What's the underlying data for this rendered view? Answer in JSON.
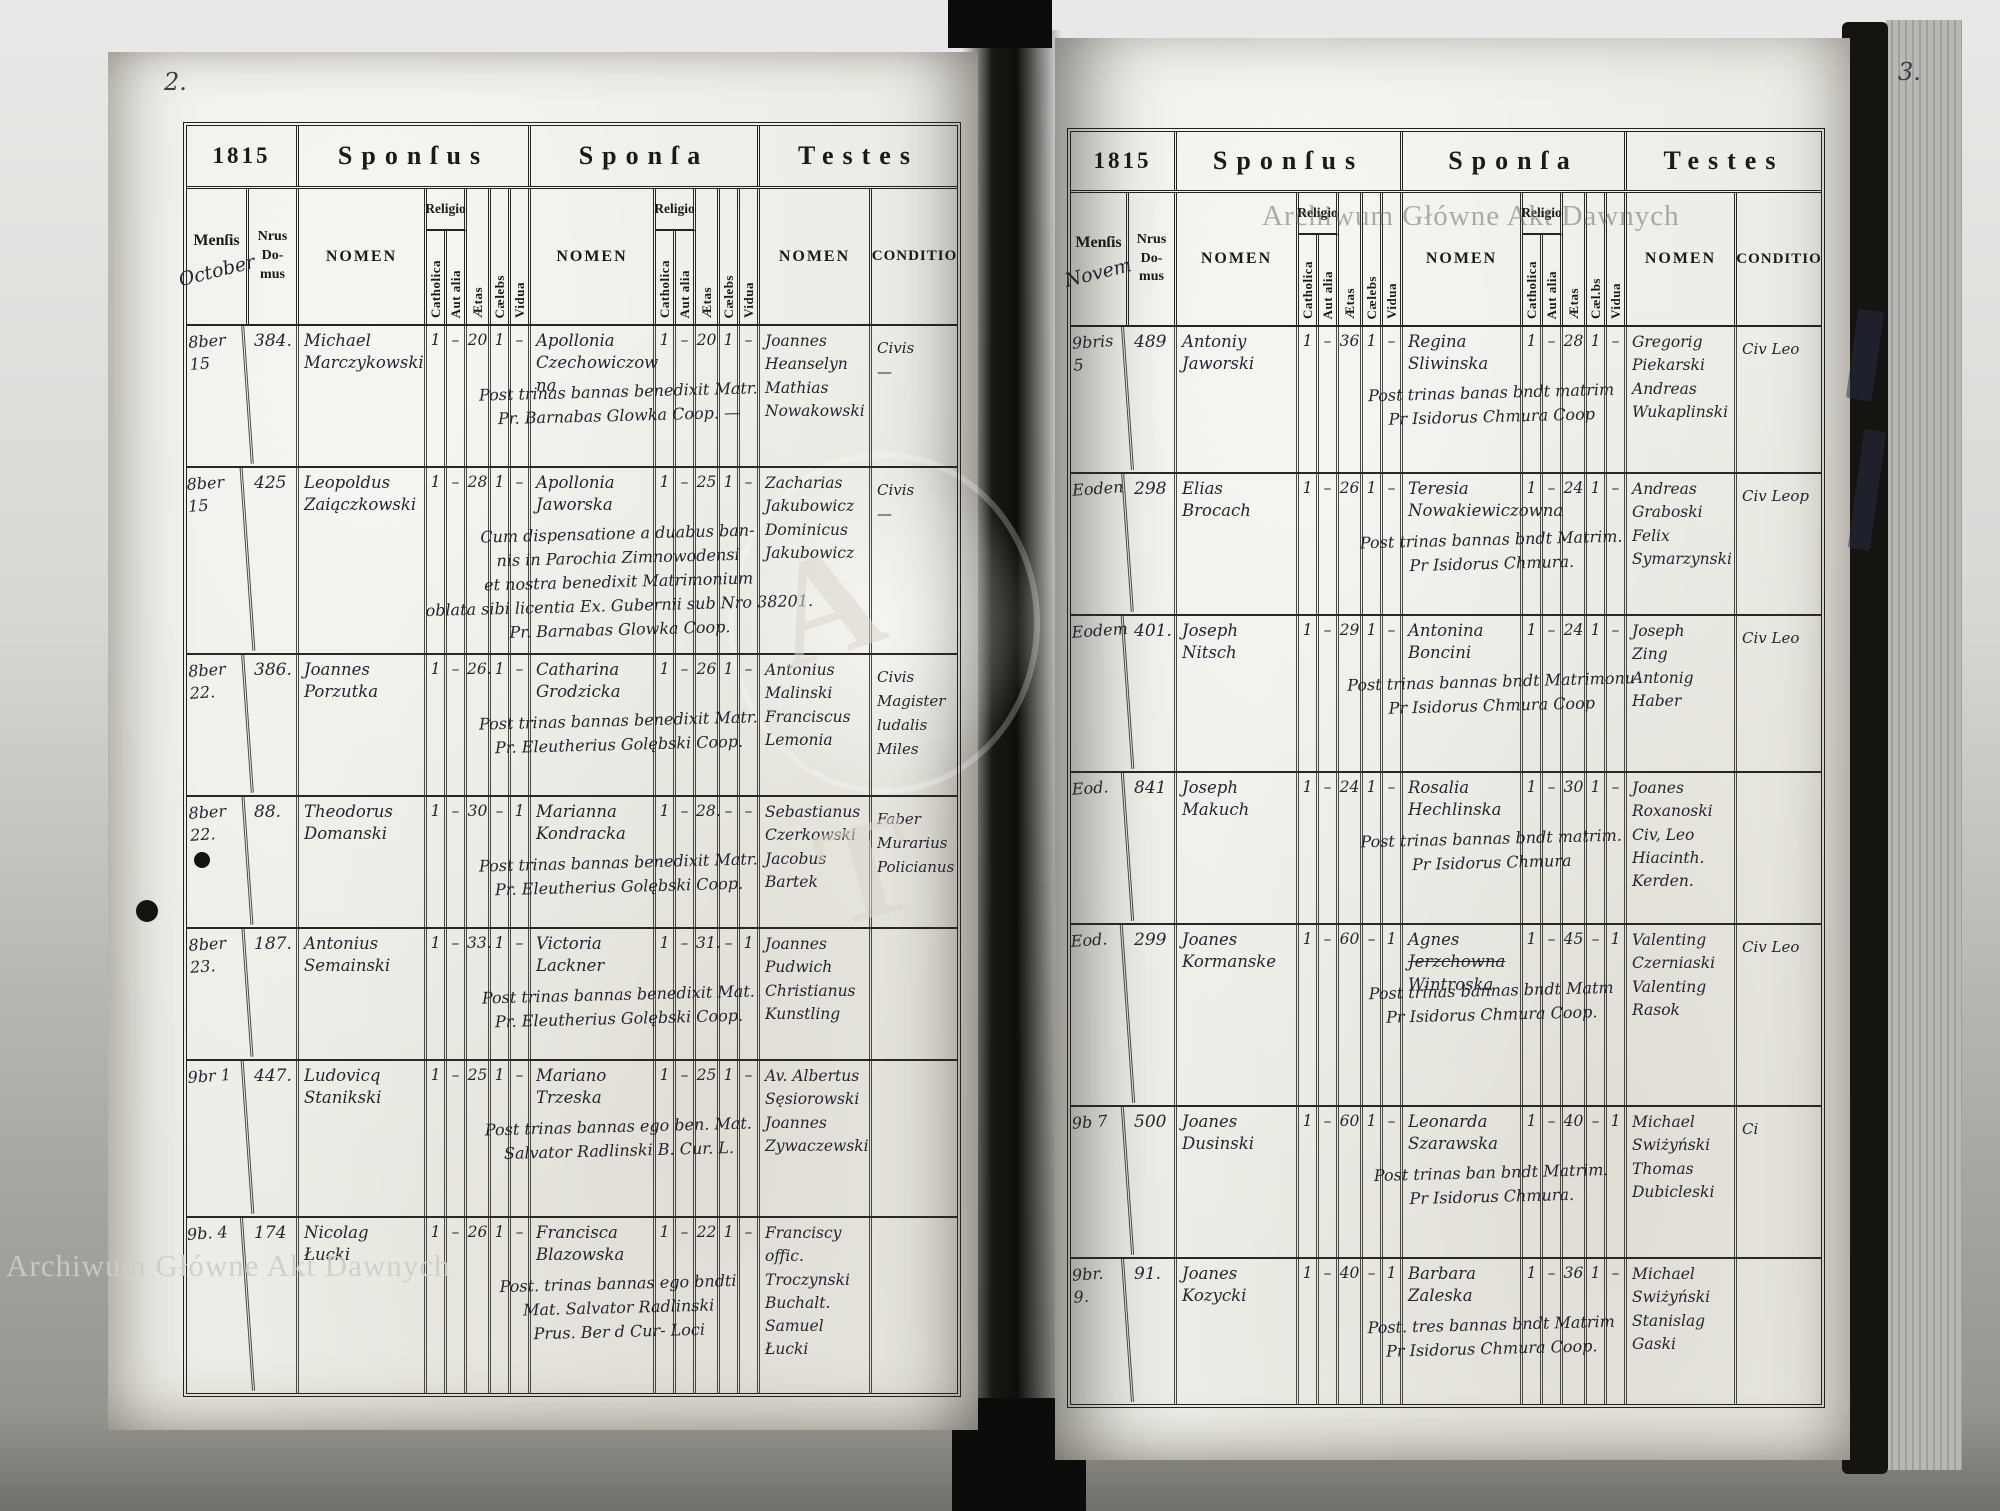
{
  "scan": {
    "watermark_top_right": "Archiwum Główne Akt Dawnych",
    "watermark_bottom_left": "Archiwum Główne Akt Dawnych",
    "ghost_letter_a": "A",
    "ghost_letter_t": "T"
  },
  "headers": {
    "year": "1815",
    "sponsus": "Sponſus",
    "sponsa": "Sponſa",
    "testes": "Testes",
    "mensis": "Menſis",
    "nrus_domus": "Nrus\nDo-\nmus",
    "nomen": "NOMEN",
    "religio": "Religio",
    "catholica": "Catholica",
    "aut_alia": "Aut alia",
    "aetas": "Ætas",
    "caelebs": "Cælebs",
    "caelebs_alt": "Cæl.bs",
    "vidua": "Vidua",
    "conditio": "CONDITIO"
  },
  "left_page": {
    "page_number": "2.",
    "month_script": "October",
    "rows": [
      {
        "date": "8ber 15",
        "no": "384.",
        "g_name": "Michael\nMarczykowski",
        "g_cath": "1",
        "g_alia": "–",
        "g_aetas": "20",
        "g_cael": "1",
        "g_vid": "–",
        "b_name": "Apollonia\nCzechowiczow\nna",
        "b_struck": "",
        "b_name3": "",
        "b_cath": "1",
        "b_alia": "–",
        "b_aetas": "20",
        "b_cael": "1",
        "b_vid": "–",
        "note": "Post trinas bannas benedixit Matr.\nPr. Barnabas Glowka Coop. —",
        "testes": "Joannes\nHeanselyn\nMathias\nNowakowski",
        "cond": "Civis\n—"
      },
      {
        "date": "8ber 15",
        "no": "425",
        "g_name": "Leopoldus\nZaiączkowski",
        "g_cath": "1",
        "g_alia": "–",
        "g_aetas": "28",
        "g_cael": "1",
        "g_vid": "–",
        "b_name": "Apollonia\nJaworska",
        "b_struck": "",
        "b_name3": "",
        "b_cath": "1",
        "b_alia": "–",
        "b_aetas": "25",
        "b_cael": "1",
        "b_vid": "–",
        "note": "Cum dispensatione a duabus ban-\nnis in Parochia Zimnowodensi\net nostra benedixit Matrimonium\noblata sibi licentia Ex. Gubernii sub Nro 38201.\nPr. Barnabas Glowka Coop.",
        "testes": "Zacharias\nJakubowicz\nDominicus\nJakubowicz",
        "cond": "Civis\n—"
      },
      {
        "date": "8ber 22.",
        "no": "386.",
        "g_name": "Joannes\nPorzutka",
        "g_cath": "1",
        "g_alia": "–",
        "g_aetas": "26.",
        "g_cael": "1",
        "g_vid": "–",
        "b_name": "Catharina\nGrodzicka",
        "b_struck": "",
        "b_name3": "",
        "b_cath": "1",
        "b_alia": "–",
        "b_aetas": "26",
        "b_cael": "1",
        "b_vid": "–",
        "note": "Post trinas bannas benedixit Matr.\nPr. Eleutherius Golębski Coop.",
        "testes": "Antonius\nMalinski\nFranciscus\nLemonia",
        "cond": "Civis\nMagister\nludalis Miles"
      },
      {
        "date": "8ber 22.",
        "no": "88.",
        "g_name": "Theodorus\nDomanski",
        "g_cath": "1",
        "g_alia": "–",
        "g_aetas": "30",
        "g_cael": "–",
        "g_vid": "1",
        "b_name": "Marianna\nKondracka",
        "b_struck": "",
        "b_name3": "",
        "b_cath": "1",
        "b_alia": "–",
        "b_aetas": "28.",
        "b_cael": "–",
        "b_vid": "–",
        "note": "Post trinas bannas benedixit Matr.\nPr. Eleutherius Golębski Coop.",
        "testes": "Sebastianus\nCzerkowski\nJacobus\nBartek",
        "cond": "Faber\nMurarius\nPolicianus"
      },
      {
        "date": "8ber 23.",
        "no": "187.",
        "g_name": "Antonius\nSemainski",
        "g_cath": "1",
        "g_alia": "–",
        "g_aetas": "33.",
        "g_cael": "1",
        "g_vid": "–",
        "b_name": "Victoria\nLackner",
        "b_struck": "",
        "b_name3": "",
        "b_cath": "1",
        "b_alia": "–",
        "b_aetas": "31.",
        "b_cael": "–",
        "b_vid": "1",
        "note": "Post trinas bannas benedixit Mat.\nPr. Eleutherius Golębski Coop.",
        "testes": "Joannes\nPudwich\nChristianus\nKunstling",
        "cond": ""
      },
      {
        "date": "9br 1",
        "no": "447.",
        "g_name": "Ludovicq\nStanikski",
        "g_cath": "1",
        "g_alia": "–",
        "g_aetas": "25",
        "g_cael": "1",
        "g_vid": "–",
        "b_name": "Mariano\nTrzeska",
        "b_struck": "",
        "b_name3": "",
        "b_cath": "1",
        "b_alia": "–",
        "b_aetas": "25",
        "b_cael": "1",
        "b_vid": "–",
        "note": "Post trinas bannas ego ben. Mat.\nSalvator Radlinski B. Cur. L.",
        "testes": "Av. Albertus\nSęsiorowski\nJoannes\nZywaczewski",
        "cond": ""
      },
      {
        "date": "9b. 4",
        "no": "174",
        "g_name": "Nicolag\nŁucki",
        "g_cath": "1",
        "g_alia": "–",
        "g_aetas": "26",
        "g_cael": "1",
        "g_vid": "–",
        "b_name": "Francisca\nBlazowska",
        "b_struck": "",
        "b_name3": "",
        "b_cath": "1",
        "b_alia": "–",
        "b_aetas": "22",
        "b_cael": "1",
        "b_vid": "–",
        "note": "Post. trinas bannas ego bndti\nMat. Salvator Radlinski\nPrus. Ber d Cur- Loci",
        "testes": "Franciscy offic.\nTroczynski Buchalt.\nSamuel\nŁucki",
        "cond": ""
      }
    ]
  },
  "right_page": {
    "page_number": "3.",
    "month_script": "Novem",
    "rows": [
      {
        "date": "9bris 5",
        "no": "489",
        "g_name": "Antoniy\nJaworski",
        "g_cath": "1",
        "g_alia": "–",
        "g_aetas": "36",
        "g_cael": "1",
        "g_vid": "–",
        "b_name": "Regina\nSliwinska",
        "b_struck": "",
        "b_name3": "",
        "b_cath": "1",
        "b_alia": "–",
        "b_aetas": "28",
        "b_cael": "1",
        "b_vid": "–",
        "note": "Post trinas banas bndt matrim\nPr Isidorus Chmura Coop",
        "testes": "Gregorig\nPiekarski\nAndreas\nWukaplinski",
        "cond": "Civ Leo"
      },
      {
        "date": "Eoden",
        "no": "298",
        "g_name": "Elias\nBrocach",
        "g_cath": "1",
        "g_alia": "–",
        "g_aetas": "26",
        "g_cael": "1",
        "g_vid": "–",
        "b_name": "Teresia\nNowakiewiczowna",
        "b_struck": "",
        "b_name3": "",
        "b_cath": "1",
        "b_alia": "–",
        "b_aetas": "24",
        "b_cael": "1",
        "b_vid": "–",
        "note": "Post trinas bannas bndt Matrim.\nPr Isidorus Chmura.",
        "testes": "Andreas\nGraboski\nFelix\nSymarzynski",
        "cond": "Civ Leop"
      },
      {
        "date": "Eodem",
        "no": "401.",
        "g_name": "Joseph\nNitsch",
        "g_cath": "1",
        "g_alia": "–",
        "g_aetas": "29",
        "g_cael": "1",
        "g_vid": "–",
        "b_name": "Antonina\nBoncini",
        "b_struck": "",
        "b_name3": "",
        "b_cath": "1",
        "b_alia": "–",
        "b_aetas": "24",
        "b_cael": "1",
        "b_vid": "–",
        "note": "Post trinas bannas bndt Matrimonu\nPr Isidorus Chmura Coop",
        "testes": "Joseph\nZing\nAntonig\nHaber",
        "cond": "Civ Leo"
      },
      {
        "date": "Eod.",
        "no": "841",
        "g_name": "Joseph\nMakuch",
        "g_cath": "1",
        "g_alia": "–",
        "g_aetas": "24",
        "g_cael": "1",
        "g_vid": "–",
        "b_name": "Rosalia\nHechlinska",
        "b_struck": "",
        "b_name3": "",
        "b_cath": "1",
        "b_alia": "–",
        "b_aetas": "30",
        "b_cael": "1",
        "b_vid": "–",
        "note": "Post trinas bannas bndt matrim.\nPr Isidorus Chmura",
        "testes": "Joanes\nRoxanoski Civ, Leo\nHiacinth.\nKerden.",
        "cond": ""
      },
      {
        "date": "Eod.",
        "no": "299",
        "g_name": "Joanes\nKormanske",
        "g_cath": "1",
        "g_alia": "–",
        "g_aetas": "60",
        "g_cael": "–",
        "g_vid": "1",
        "b_name": "Agnes",
        "b_struck": "Jerzchowna",
        "b_name3": "Wintroska",
        "b_cath": "1",
        "b_alia": "–",
        "b_aetas": "45",
        "b_cael": "–",
        "b_vid": "1",
        "note": "Post trinas bannas bndt Matm\nPr Isidorus Chmura Coop.",
        "testes": "Valenting\nCzerniaski\nValenting\nRasok",
        "cond": "Civ Leo"
      },
      {
        "date": "9b 7",
        "no": "500",
        "g_name": "Joanes\nDusinski",
        "g_cath": "1",
        "g_alia": "–",
        "g_aetas": "60",
        "g_cael": "1",
        "g_vid": "–",
        "b_name": "Leonarda\nSzarawska",
        "b_struck": "",
        "b_name3": "",
        "b_cath": "1",
        "b_alia": "–",
        "b_aetas": "40",
        "b_cael": "–",
        "b_vid": "1",
        "note": "Post trinas ban bndt Matrim.\nPr Isidorus Chmura.",
        "testes": "Michael\nSwiżyński\nThomas\nDubicleski",
        "cond": "Ci"
      },
      {
        "date": "9br. 9.",
        "no": "91.",
        "g_name": "Joanes\nKozycki",
        "g_cath": "1",
        "g_alia": "–",
        "g_aetas": "40",
        "g_cael": "–",
        "g_vid": "1",
        "b_name": "Barbara\nZaleska",
        "b_struck": "",
        "b_name3": "",
        "b_cath": "1",
        "b_alia": "–",
        "b_aetas": "36",
        "b_cael": "1",
        "b_vid": "–",
        "note": "Post. tres bannas bndt Matrim\nPr Isidorus Chmura Coop.",
        "testes": "Michael\nSwiżyński\nStanislag\nGaski",
        "cond": ""
      }
    ]
  }
}
